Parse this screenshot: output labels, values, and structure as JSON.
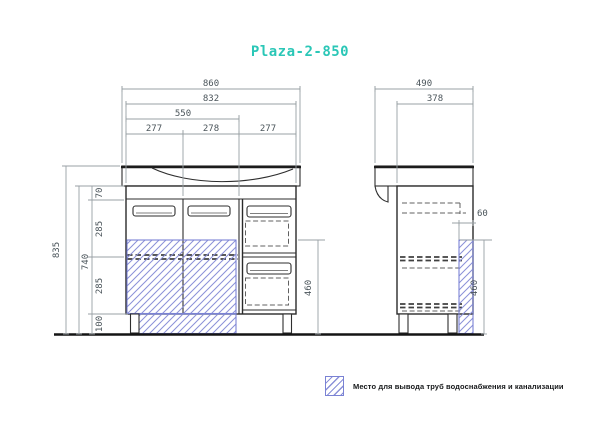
{
  "title": "Plaza-2-850",
  "colors": {
    "accent": "#2bc7b7",
    "hatch": "#8a90d8",
    "hatch_border": "#7a82d4",
    "object_line": "#2a2a2a",
    "dim_line": "#98a0a4",
    "dim_text": "#4a545a"
  },
  "dims": {
    "front": {
      "w_total": "860",
      "w_body": "832",
      "w_doors": "550",
      "w_door1": "277",
      "w_door2": "278",
      "w_drawers": "277",
      "h_total": "835",
      "h_body": "740",
      "h_top": "70",
      "h_mid1": "285",
      "h_mid2": "285",
      "h_feet": "100",
      "h_pipe": "460"
    },
    "side": {
      "d_total": "490",
      "d_body": "378",
      "pipe_zone": "60",
      "h_pipe": "460"
    }
  },
  "legend": {
    "swatch": "hatched-square",
    "text": "Место для вывода труб водоснабжения и канализации"
  }
}
